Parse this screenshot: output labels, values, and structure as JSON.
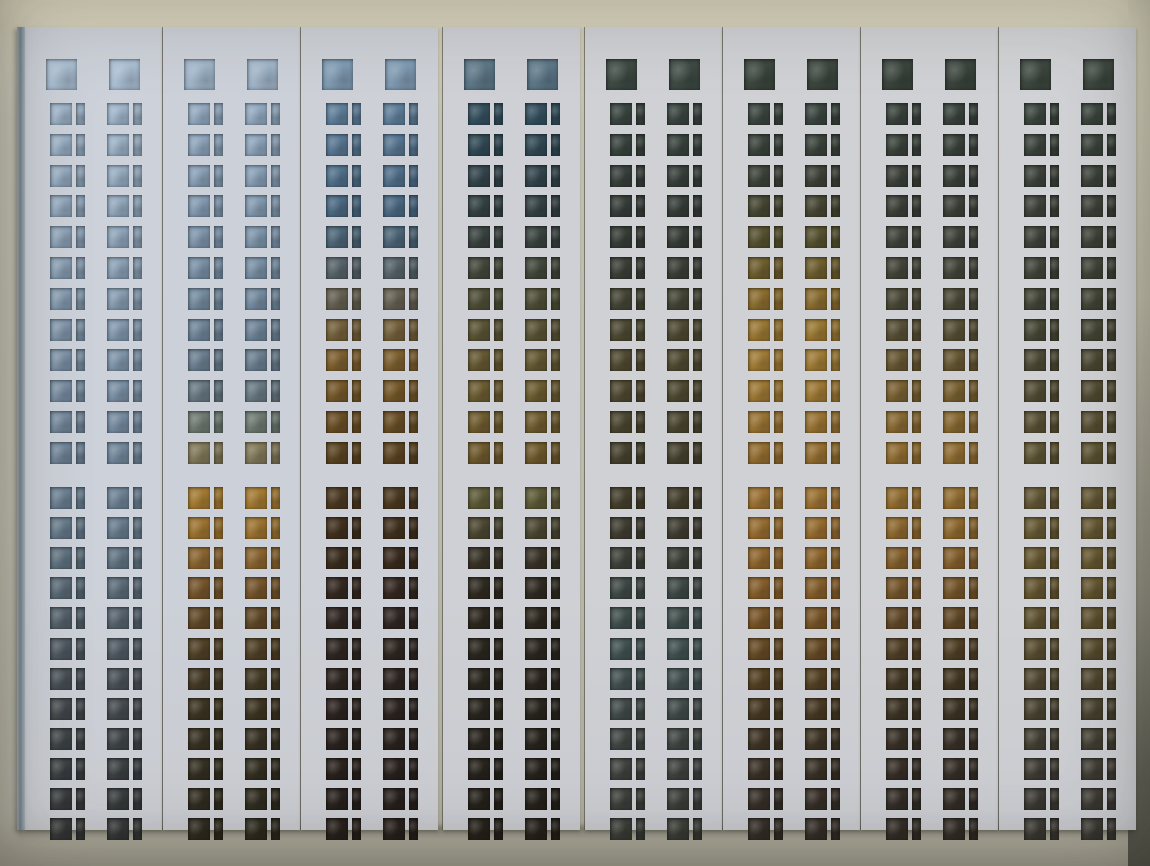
{
  "photo": {
    "subject": "eight vertical film test strips with two columns of punched rectangular windows, laid on a beige mat",
    "strip_count": 8,
    "columns_per_strip": 2,
    "rows_per_column": {
      "header_squares": 1,
      "upper_group": 12,
      "lower_group": 12
    }
  },
  "background": {
    "top_band": "#ded9c3",
    "mat": "#c6c4b6",
    "mat_bottom": "#aba898",
    "right_edge_dark": "#5f5e55",
    "shadow": "#3c3a30"
  },
  "strips": [
    {
      "card_color": "#cdd1d9",
      "header_color": "#a9bed2",
      "row_colors": [
        "#9eb4c9",
        "#9ab0c5",
        "#96acc1",
        "#92a8bd",
        "#8ea4b9",
        "#8aa0b5",
        "#869cb1",
        "#8298ad",
        "#7e94a9",
        "#7a90a5",
        "#768ba0",
        "#72879b",
        "#6d8295",
        "#687c8d",
        "#627483",
        "#5c6c79",
        "#56636e",
        "#505a63",
        "#4a5258",
        "#454b4f",
        "#404648",
        "#3c4143",
        "#393d3e",
        "#373a3a"
      ]
    },
    {
      "card_color": "#ccd0d8",
      "header_color": "#9fb4c8",
      "row_colors": [
        "#92a9bf",
        "#8da4ba",
        "#889fb5",
        "#839ab0",
        "#7e95ab",
        "#7990a5",
        "#748b9f",
        "#6f8599",
        "#6b7f90",
        "#697a84",
        "#6f7a72",
        "#82795a",
        "#a37a31",
        "#9c7330",
        "#8a6430",
        "#75552c",
        "#614928",
        "#504026",
        "#443a25",
        "#3d3522",
        "#383223",
        "#343022",
        "#322e21",
        "#302c20"
      ]
    },
    {
      "card_color": "#cdd0d6",
      "header_color": "#7f9ab2",
      "row_colors": [
        "#5f7f9a",
        "#587792",
        "#51708a",
        "#4b6982",
        "#4d6678",
        "#57646b",
        "#656051",
        "#74603b",
        "#7d5f2f",
        "#755829",
        "#694e25",
        "#5b4422",
        "#4b3921",
        "#41311e",
        "#3a2c1d",
        "#352921",
        "#312723",
        "#2f2621",
        "#2d2520",
        "#2c2420",
        "#2b231f",
        "#2a221e",
        "#29221e",
        "#29211d"
      ]
    },
    {
      "card_color": "#ced0d5",
      "header_color": "#5d7787",
      "row_colors": [
        "#34505e",
        "#324a55",
        "#33454c",
        "#354245",
        "#39433f",
        "#42483b",
        "#4e4e37",
        "#5a5435",
        "#655933",
        "#6c5c31",
        "#6f5c2f",
        "#6f5a2d",
        "#5d5a37",
        "#4b4731",
        "#393327",
        "#302b21",
        "#2d281f",
        "#2b271f",
        "#2a261e",
        "#29251e",
        "#28241d",
        "#28231d",
        "#27231c",
        "#27221c"
      ]
    },
    {
      "card_color": "#cfd1d5",
      "header_color": "#3e4a44",
      "row_colors": [
        "#3a4540",
        "#39433d",
        "#38403b",
        "#373e39",
        "#373d37",
        "#3b3f37",
        "#444535",
        "#4d4933",
        "#504a31",
        "#4f4931",
        "#4b4630",
        "#47422f",
        "#453f2d",
        "#403d31",
        "#3e4139",
        "#3f4945",
        "#404f4d",
        "#415251",
        "#42504f",
        "#414b49",
        "#404643",
        "#3f433f",
        "#3e413c",
        "#3d3f3a"
      ]
    },
    {
      "card_color": "#d0d1d5",
      "header_color": "#3c463e",
      "row_colors": [
        "#3b453f",
        "#3b433c",
        "#3d4339",
        "#464733",
        "#565130",
        "#6e5e2f",
        "#8b6d2f",
        "#9a7833",
        "#9f7b35",
        "#9d7834",
        "#997333",
        "#946e31",
        "#9b7132",
        "#966c30",
        "#8e652d",
        "#855e2b",
        "#785528",
        "#664a25",
        "#544123",
        "#473923",
        "#3f3525",
        "#3a3227",
        "#383129",
        "#373029"
      ]
    },
    {
      "card_color": "#d0d1d4",
      "header_color": "#3a443c",
      "row_colors": [
        "#3a433d",
        "#3a423b",
        "#3b413a",
        "#3d4139",
        "#40433a",
        "#444539",
        "#4b4937",
        "#574f35",
        "#675733",
        "#796132",
        "#886932",
        "#906d32",
        "#936e31",
        "#8e692f",
        "#84602d",
        "#75562b",
        "#624928",
        "#503f25",
        "#443824",
        "#3d3425",
        "#393127",
        "#373028",
        "#362f28",
        "#352f28"
      ]
    },
    {
      "card_color": "#d1d2d5",
      "header_color": "#3d473f",
      "row_colors": [
        "#3c463f",
        "#3c443d",
        "#3d433c",
        "#3e433b",
        "#3f443a",
        "#414539",
        "#444638",
        "#484837",
        "#4d4a36",
        "#534d35",
        "#595135",
        "#5e5535",
        "#635735",
        "#665934",
        "#675933",
        "#655732",
        "#605331",
        "#594e31",
        "#524932",
        "#4b4433",
        "#454135",
        "#413e36",
        "#3f3c36",
        "#3d3b35"
      ]
    }
  ]
}
